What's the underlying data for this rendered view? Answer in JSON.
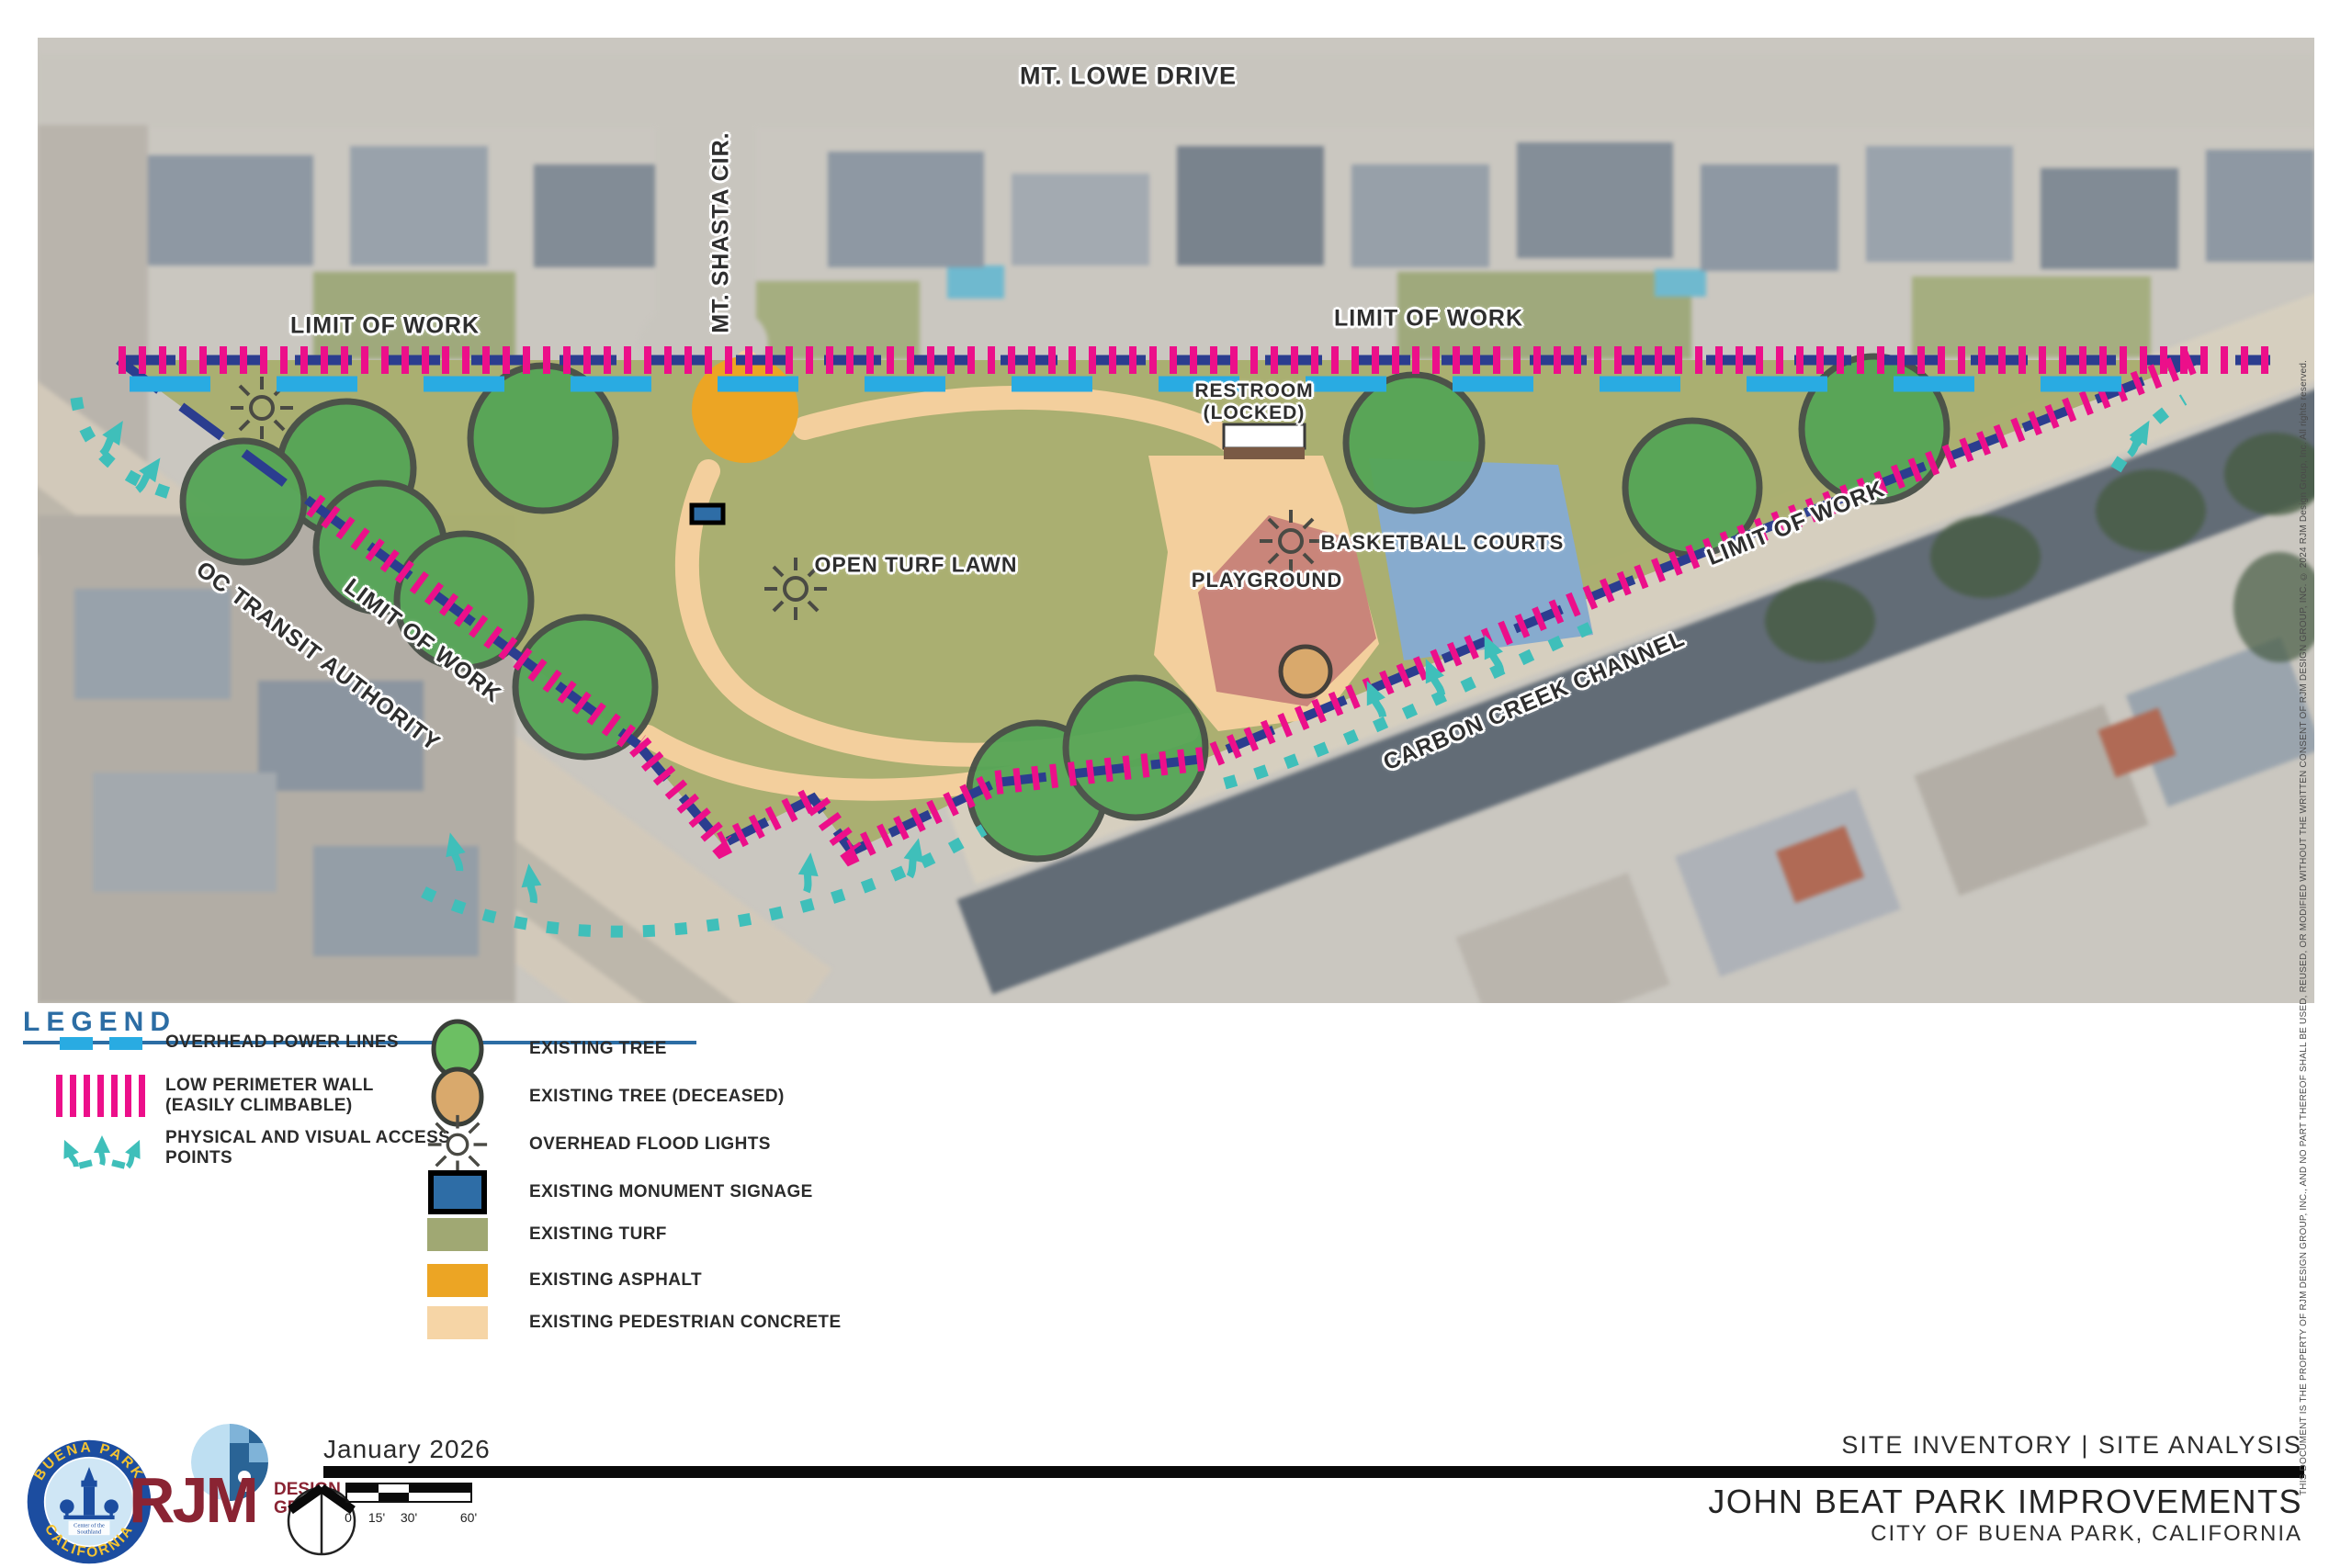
{
  "map": {
    "labels": {
      "mt_lowe_drive": "MT. LOWE DRIVE",
      "mt_shasta_cir": "MT. SHASTA CIR.",
      "limit_of_work_top_left": "LIMIT OF WORK",
      "limit_of_work_top_right": "LIMIT OF WORK",
      "limit_of_work_left_diag": "LIMIT OF WORK",
      "limit_of_work_right_diag": "LIMIT OF WORK",
      "oc_transit_authority": "OC TRANSIT AUTHORITY",
      "carbon_creek_channel": "CARBON CREEK CHANNEL",
      "open_turf_lawn": "OPEN TURF LAWN",
      "restroom_line1": "RESTROOM",
      "restroom_line2": "(LOCKED)",
      "basketball_courts": "BASKETBALL COURTS",
      "playground": "PLAYGROUND"
    }
  },
  "legend": {
    "title": "LEGEND",
    "left_items": [
      {
        "symbol": "overhead-power-lines",
        "label": "OVERHEAD POWER LINES",
        "label2": ""
      },
      {
        "symbol": "low-perimeter-wall",
        "label": "LOW PERIMETER WALL",
        "label2": "(EASILY CLIMBABLE)"
      },
      {
        "symbol": "access-points",
        "label": "PHYSICAL AND VISUAL ACCESS",
        "label2": "POINTS"
      }
    ],
    "right_items": [
      {
        "symbol": "existing-tree",
        "label": "EXISTING TREE"
      },
      {
        "symbol": "existing-tree-deceased",
        "label": "EXISTING TREE (DECEASED)"
      },
      {
        "symbol": "overhead-flood-lights",
        "label": "OVERHEAD FLOOD LIGHTS"
      },
      {
        "symbol": "existing-monument-signage",
        "label": "EXISTING MONUMENT SIGNAGE"
      },
      {
        "symbol": "existing-turf",
        "label": "EXISTING TURF"
      },
      {
        "symbol": "existing-asphalt",
        "label": "EXISTING ASPHALT"
      },
      {
        "symbol": "existing-pedestrian-concrete",
        "label": "EXISTING PEDESTRIAN CONCRETE"
      }
    ]
  },
  "title_block": {
    "date": "January 2026",
    "sheet_title": "SITE INVENTORY | SITE ANALYSIS",
    "project_title": "JOHN BEAT PARK IMPROVEMENTS",
    "project_location": "CITY OF BUENA PARK, CALIFORNIA"
  },
  "logos": {
    "city_seal": {
      "arc_top": "BUENA PARK",
      "arc_bottom": "CALIFORNIA",
      "center_line1": "Center of the",
      "center_line2": "Southland"
    },
    "rjm": {
      "name": "RJM",
      "sub_line1": "DESIGN",
      "sub_line2": "GROUP"
    }
  },
  "scale_bar": {
    "ticks": [
      "0",
      "15'",
      "30'",
      "60'"
    ]
  },
  "copyright_notice": "THIS DOCUMENT IS THE PROPERTY OF RJM DESIGN GROUP, INC.,  AND NO PART THEREOF SHALL BE USED, REUSED, OR MODIFIED WITHOUT THE WRITTEN CONSENT OF RJM DESIGN GROUP, INC.  © 2024 RJM Design Group, Inc.   All rights reserved.",
  "colors": {
    "turf": "#a9ae6d",
    "asphalt": "#eca524",
    "pedestrian_concrete": "#f3cf9d",
    "basketball_court": "#87abce",
    "playground": "#c9857a",
    "tree": "#55a556",
    "tree_deceased": "#d9a96c",
    "overhead_power_line": "#29abe2",
    "perimeter_wall": "#ec0f8a",
    "limit_of_work": "#2b3d8f",
    "access_point": "#3fbfba",
    "monument_signage": "#2e6da6",
    "legend_heading": "#2c6da4"
  }
}
